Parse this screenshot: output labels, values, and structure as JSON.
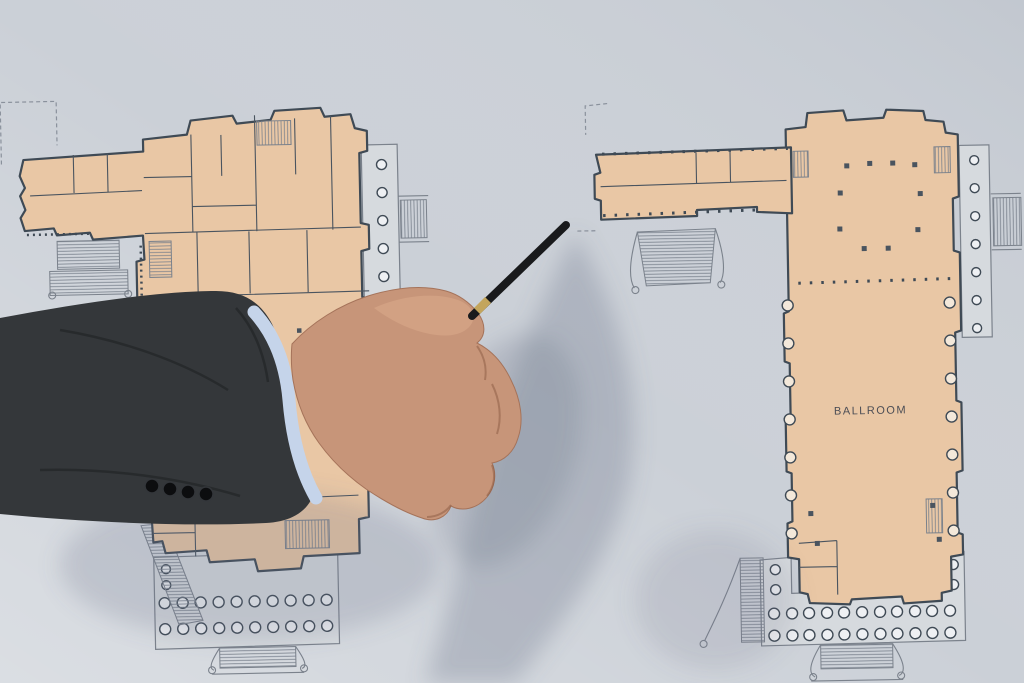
{
  "scene": {
    "colors": {
      "board": "#cbd0d7",
      "plan_fill": "#e9c7a5",
      "wall_line": "#3f4a55",
      "terrace": "#d6dade",
      "terrace_line": "#7b828c",
      "suit": "#34373a",
      "shirt_cuff": "#c5d4ea",
      "skin": "#c79579",
      "pen": "#191a1c",
      "pen_band": "#c3a55c",
      "shadow": "#6b7487"
    }
  },
  "right_plan": {
    "ballroom_label": "BALLROOM"
  }
}
